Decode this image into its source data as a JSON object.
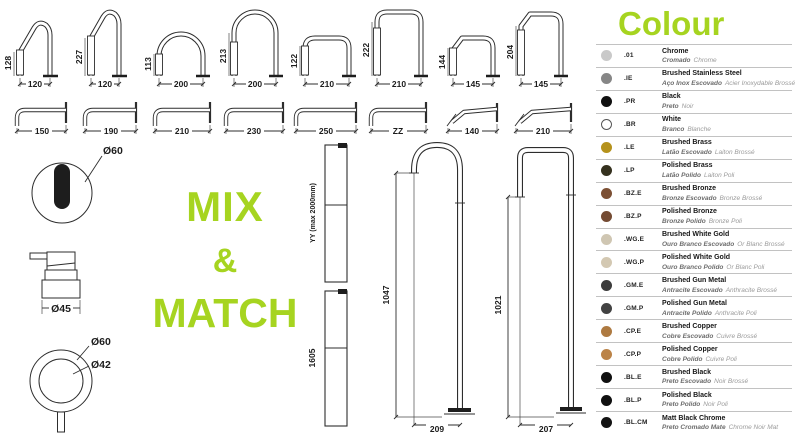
{
  "accent_green": "#a6d420",
  "mix_match": {
    "l1": "MIX",
    "l2": "&",
    "l3": "MATCH"
  },
  "drawings": {
    "top_spouts": [
      {
        "h": "128",
        "w": "120"
      },
      {
        "h": "227",
        "w": "120"
      },
      {
        "h": "113",
        "w": "200"
      },
      {
        "h": "213",
        "w": "200"
      },
      {
        "h": "122",
        "w": "210"
      },
      {
        "h": "222",
        "w": "210"
      },
      {
        "h": "144",
        "w": "145"
      },
      {
        "h": "204",
        "w": "145"
      }
    ],
    "wall_spouts": [
      {
        "w": "150"
      },
      {
        "w": "190"
      },
      {
        "w": "210"
      },
      {
        "w": "230"
      },
      {
        "w": "250"
      },
      {
        "w": "ZZ"
      },
      {
        "w": "140"
      },
      {
        "w": "210"
      }
    ],
    "sensor": {
      "label": "Ø60"
    },
    "dispenser": {
      "label": "Ø45"
    },
    "handle": {
      "outer": "Ø60",
      "inner": "Ø42"
    },
    "column_adjustable": {
      "label": "YY (max 2000mm)"
    },
    "column_fixed": {
      "label": "1605"
    },
    "floor_round": {
      "h": "1047",
      "w": "209"
    },
    "floor_square": {
      "h": "1021",
      "w": "207"
    }
  },
  "legend": {
    "title": "Colour",
    "rows": [
      {
        "code": ".01",
        "name": "Chrome",
        "pt": "Cromado",
        "fr": "Chrome",
        "swatch": "#c9c9c9"
      },
      {
        "code": ".IE",
        "name": "Brushed Stainless Steel",
        "pt": "Aço Inox Escovado",
        "fr": "Acier Inoxydable Brossé",
        "swatch": "#868686"
      },
      {
        "code": ".PR",
        "name": "Black",
        "pt": "Preto",
        "fr": "Noir",
        "swatch": "#101010"
      },
      {
        "code": ".BR",
        "name": "White",
        "pt": "Branco",
        "fr": "Blanche",
        "swatch": "#ffffff",
        "border": true
      },
      {
        "code": ".LE",
        "name": "Brushed Brass",
        "pt": "Latão Escovado",
        "fr": "Laiton Brossé",
        "swatch": "#b5921c"
      },
      {
        "code": ".LP",
        "name": "Polished Brass",
        "pt": "Latão Polido",
        "fr": "Laiton Poli",
        "swatch": "#35311e"
      },
      {
        "code": ".BZ.E",
        "name": "Brushed Bronze",
        "pt": "Bronze Escovado",
        "fr": "Bronze Brossé",
        "swatch": "#7c5034"
      },
      {
        "code": ".BZ.P",
        "name": "Polished Bronze",
        "pt": "Bronze Polido",
        "fr": "Bronze Poli",
        "swatch": "#744b33"
      },
      {
        "code": ".WG.E",
        "name": "Brushed White Gold",
        "pt": "Ouro Branco Escovado",
        "fr": "Or Blanc Brossé",
        "swatch": "#cfc6b2"
      },
      {
        "code": ".WG.P",
        "name": "Polished White Gold",
        "pt": "Ouro Branco Polido",
        "fr": "Or Blanc Poli",
        "swatch": "#d3c8b2"
      },
      {
        "code": ".GM.E",
        "name": "Brushed Gun Metal",
        "pt": "Antracite Escovado",
        "fr": "Anthracite Brossé",
        "swatch": "#3c3c3c"
      },
      {
        "code": ".GM.P",
        "name": "Polished Gun Metal",
        "pt": "Antracite Polido",
        "fr": "Anthracite Poli",
        "swatch": "#424242"
      },
      {
        "code": ".CP.E",
        "name": "Brushed Copper",
        "pt": "Cobre Escovado",
        "fr": "Cuivre Brossé",
        "swatch": "#ae7a41"
      },
      {
        "code": ".CP.P",
        "name": "Polished Copper",
        "pt": "Cobre Polido",
        "fr": "Cuivre Poli",
        "swatch": "#bb8347"
      },
      {
        "code": ".BL.E",
        "name": "Brushed Black",
        "pt": "Preto Escovado",
        "fr": "Noir Brossé",
        "swatch": "#101010"
      },
      {
        "code": ".BL.P",
        "name": "Polished Black",
        "pt": "Preto Polido",
        "fr": "Noir Poli",
        "swatch": "#101010"
      },
      {
        "code": ".BL.CM",
        "name": "Matt Black Chrome",
        "pt": "Preto Cromado Mate",
        "fr": "Chrome Noir Mat",
        "swatch": "#131313"
      }
    ]
  }
}
